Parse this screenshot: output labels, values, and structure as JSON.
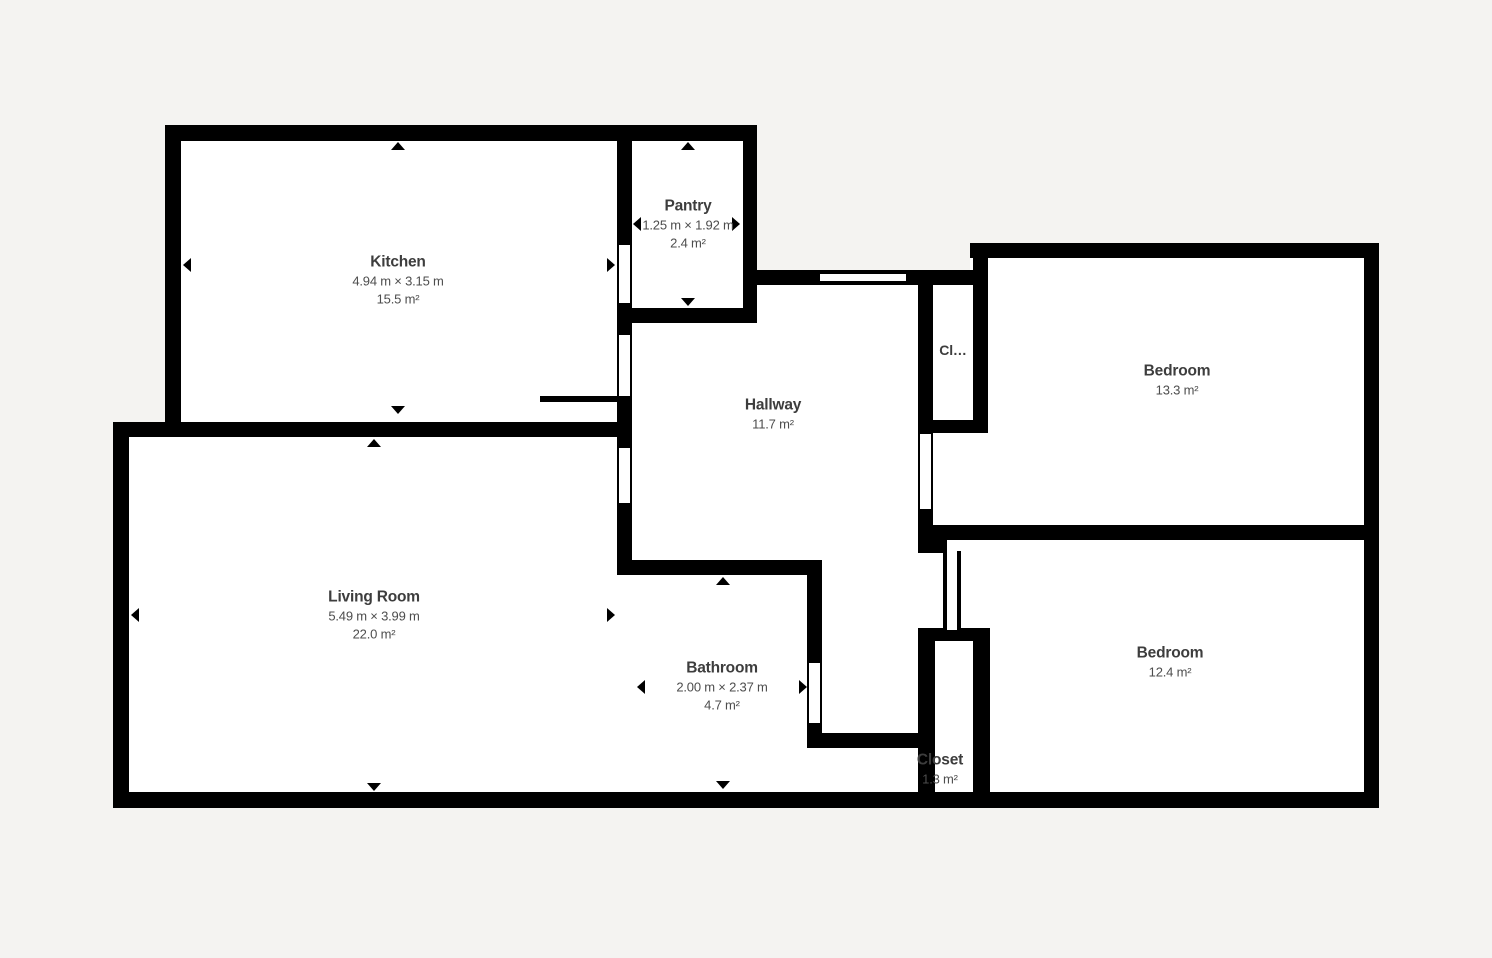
{
  "plan_title": "Apartment floor plan",
  "colors": {
    "background": "#f4f3f1",
    "wall": "#000000",
    "floor": "#ffffff",
    "room_name_text": "#3d3d3d",
    "room_dim_text": "#4d4d4d"
  },
  "rooms": [
    {
      "id": "kitchen",
      "name": "Kitchen",
      "dimensions": "4.94 m × 3.15 m",
      "area": "15.5 m²"
    },
    {
      "id": "pantry",
      "name": "Pantry",
      "dimensions": "1.25 m × 1.92 m",
      "area": "2.4 m²"
    },
    {
      "id": "hallway",
      "name": "Hallway",
      "area": "11.7 m²"
    },
    {
      "id": "closet-upper",
      "name": "Cl…"
    },
    {
      "id": "bedroom-1",
      "name": "Bedroom",
      "area": "13.3 m²"
    },
    {
      "id": "living-room",
      "name": "Living Room",
      "dimensions": "5.49 m × 3.99 m",
      "area": "22.0 m²"
    },
    {
      "id": "bathroom",
      "name": "Bathroom",
      "dimensions": "2.00 m × 2.37 m",
      "area": "4.7 m²"
    },
    {
      "id": "closet-lower",
      "name": "Closet",
      "area": "1.3 m²"
    },
    {
      "id": "bedroom-2",
      "name": "Bedroom",
      "area": "12.4 m²"
    }
  ]
}
